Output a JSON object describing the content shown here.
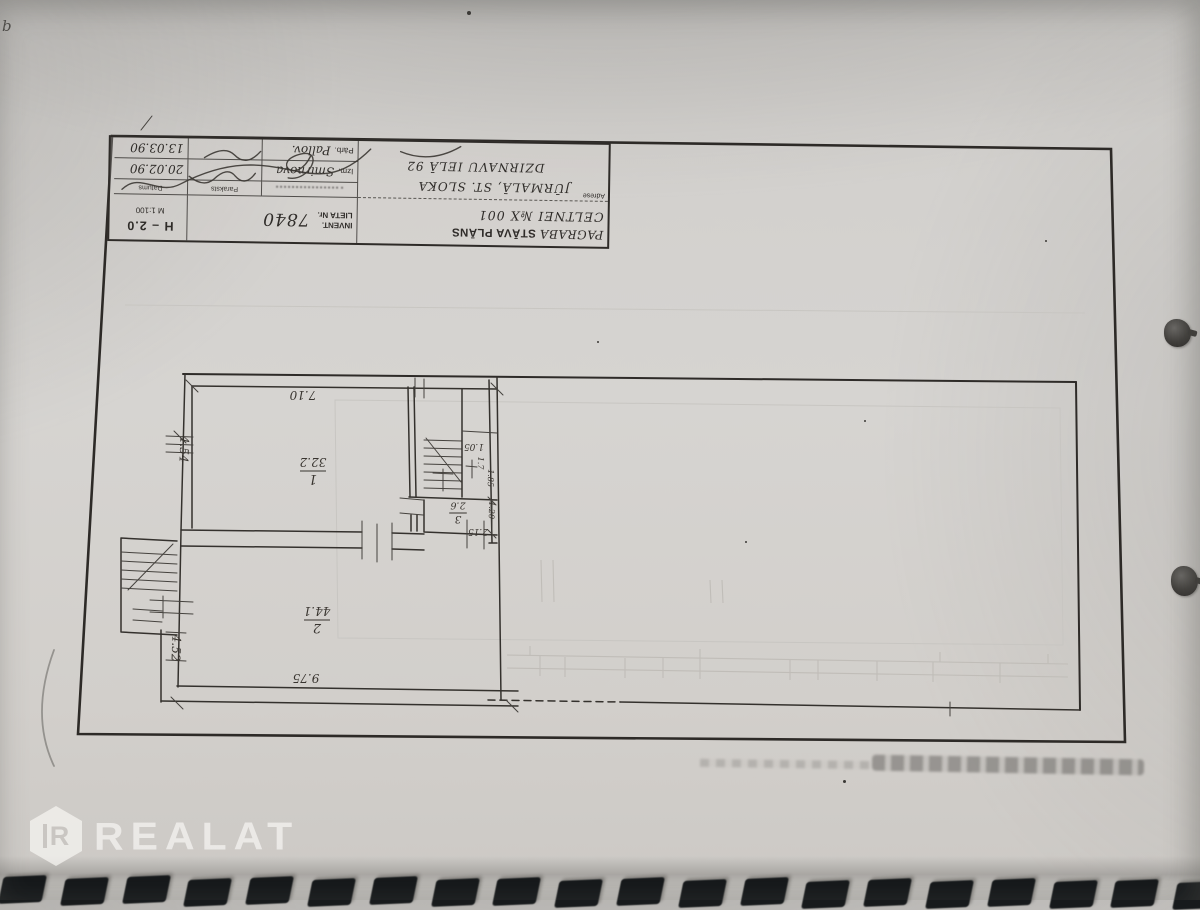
{
  "photo": {
    "corner_mark": "b"
  },
  "watermark": {
    "brand": "REALAT",
    "monogram": "R"
  },
  "title_block": {
    "title_hand": "PAGRABA",
    "title_printed": "STĀVA PLĀNS",
    "title_line2": "CELTNEI №X 001",
    "address_label": "Adrese",
    "address_line1": "JŪRMALĀ, ST. SLOKA",
    "address_line2": "DZIRNAVU IELĀ 92",
    "invent_label_line1": "INVENT.",
    "invent_label_line2": "LIETA Nr.",
    "invent_number": "7840",
    "height_mark": "H – 2.0",
    "scale": "M 1:100",
    "col_signature": "Paraksts",
    "col_date": "Datums",
    "rows": [
      {
        "role": "Izm.",
        "name": "Smirnova",
        "date": "20.02.90"
      },
      {
        "role": "Pārb.",
        "name": "Pallov.",
        "date": "13.03.90"
      }
    ]
  },
  "plan": {
    "rooms": [
      {
        "number": "1",
        "area": "32.2"
      },
      {
        "number": "2",
        "area": "44.1"
      },
      {
        "number": "3",
        "area": "2.6"
      }
    ],
    "dims": {
      "room1_width": "7.10",
      "room1_depth": "4.54",
      "room2_width": "9.75",
      "room2_depth": "4.52",
      "lobby_depth": "1.05",
      "stair_width": "1.7",
      "stair_depth": "1.85",
      "room3_width": "1.20",
      "room3_depth": "2.15"
    }
  },
  "notebook_binding": {
    "hole_count": 20
  }
}
